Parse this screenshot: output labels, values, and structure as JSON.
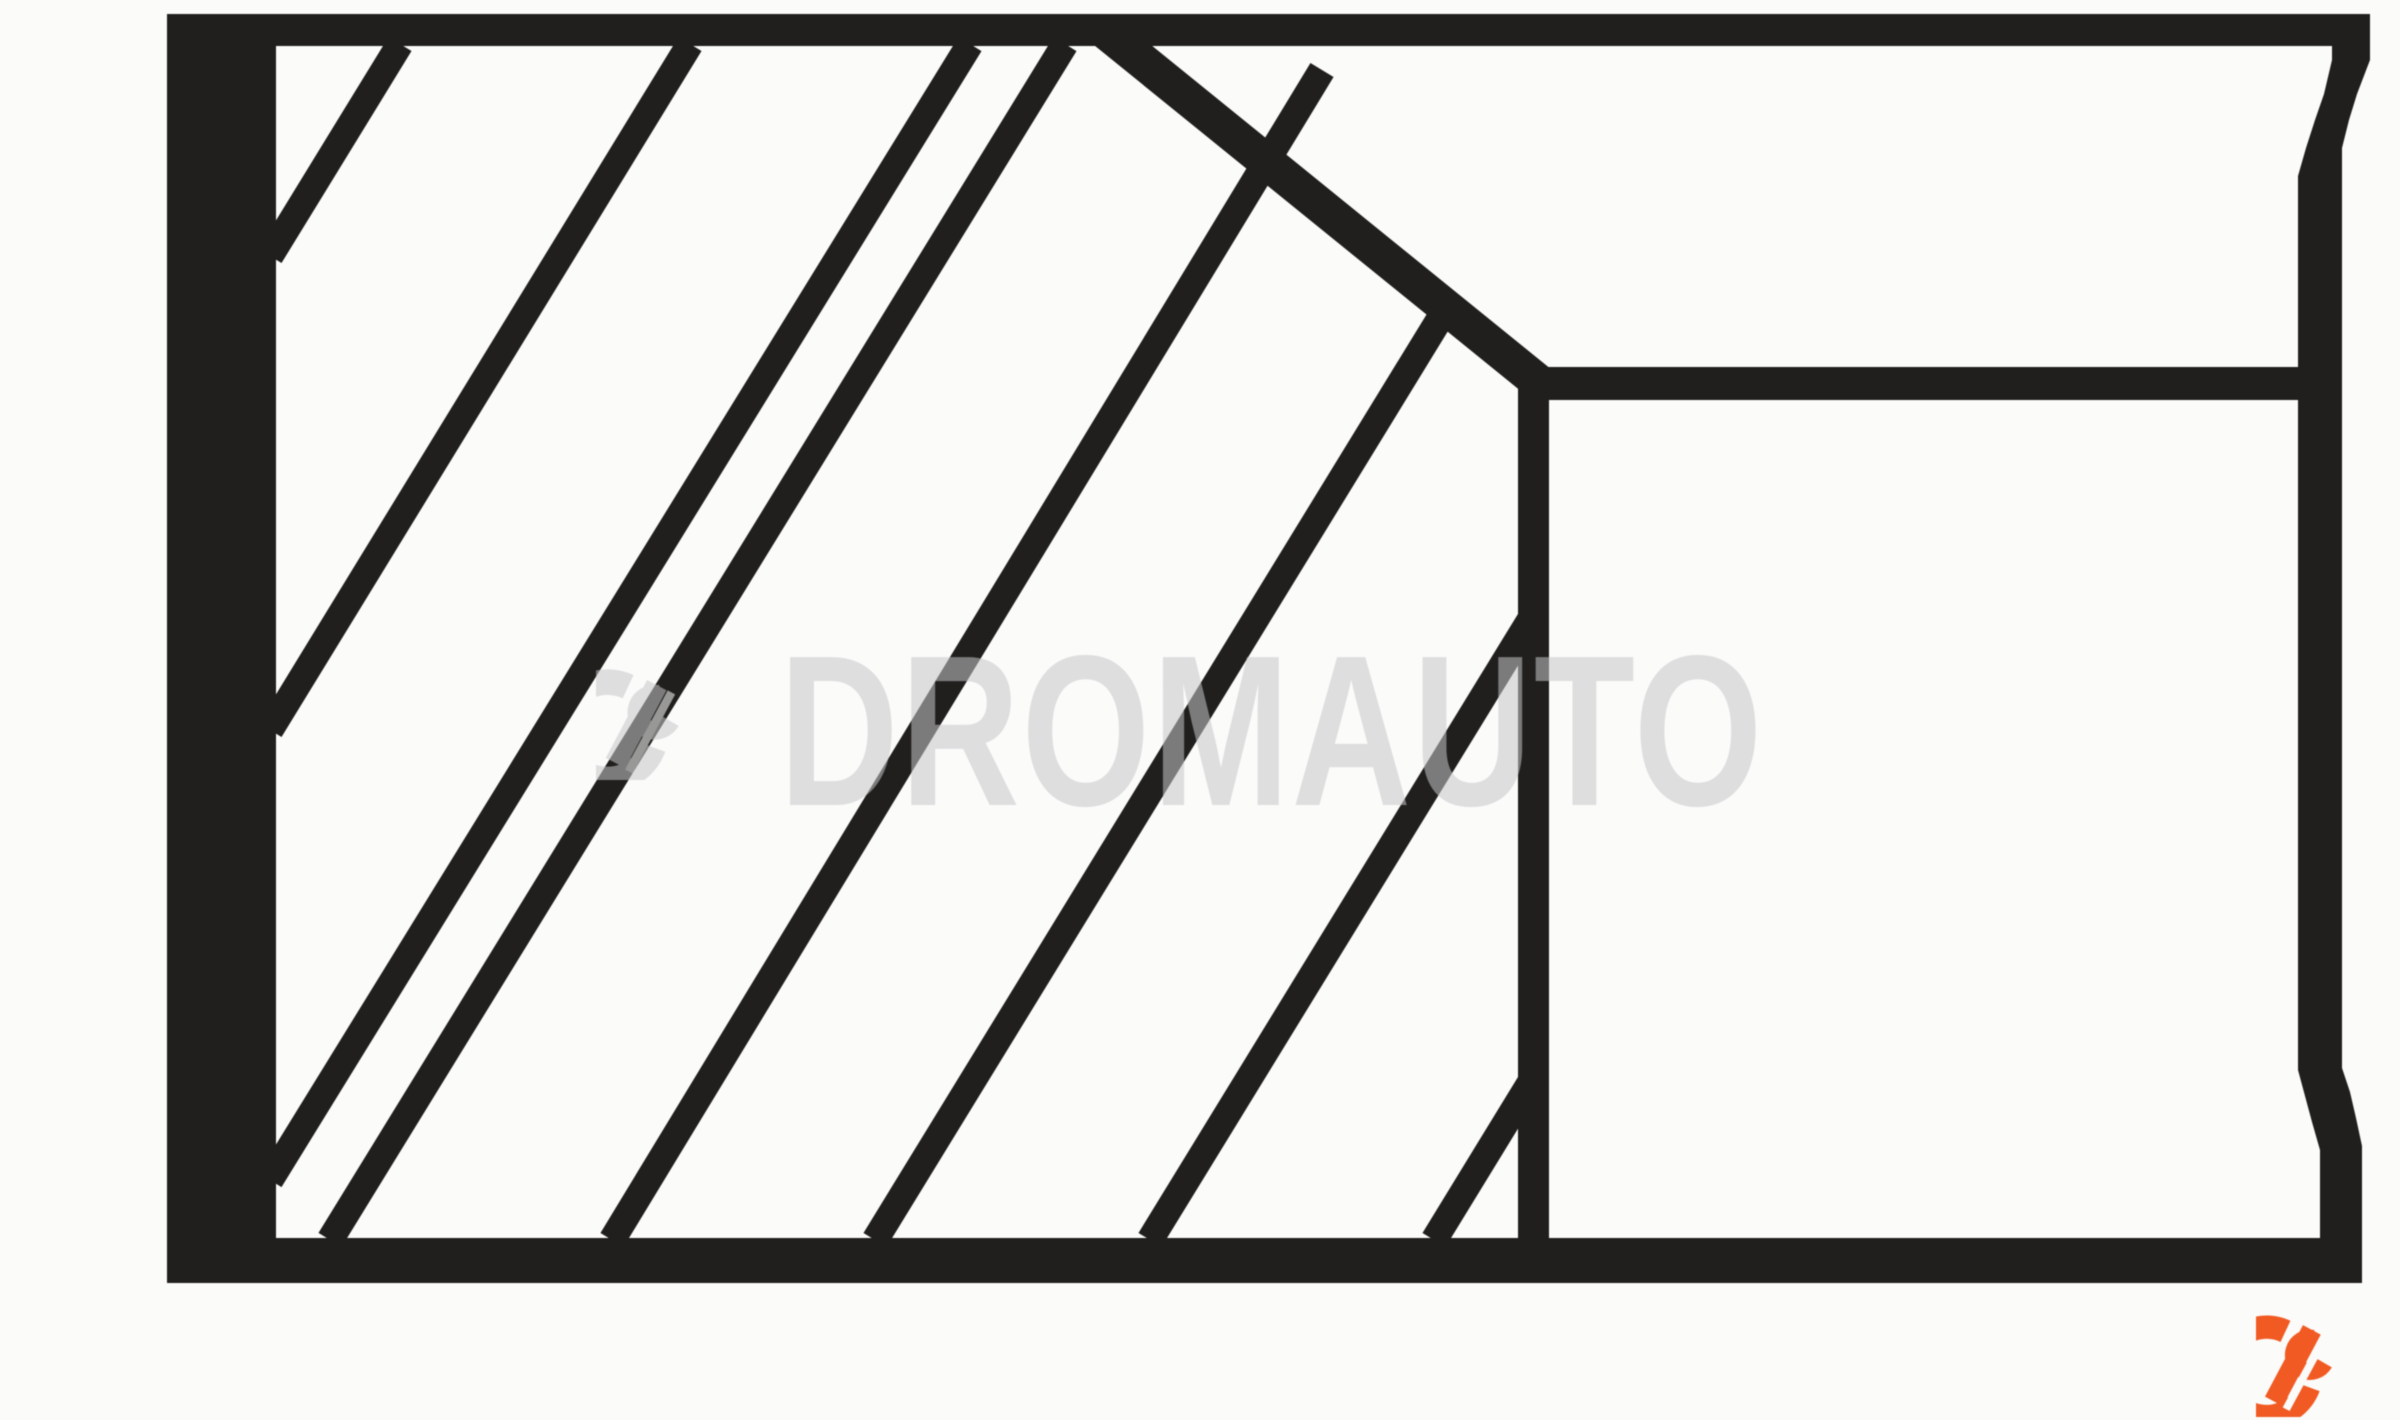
{
  "image": {
    "kind": "technical-line-drawing",
    "subject": "piston-ring-cross-section",
    "background_color": "#fbfbfa",
    "ink_color": "#201f1d"
  },
  "watermark": {
    "text": "DROMAUTO",
    "icon": "dromauto-d-mark-icon",
    "color": "#c7c7ca",
    "opacity": "0.55"
  },
  "brand_logo": {
    "icon": "dromauto-d-mark-icon",
    "color": "#f15a22"
  }
}
